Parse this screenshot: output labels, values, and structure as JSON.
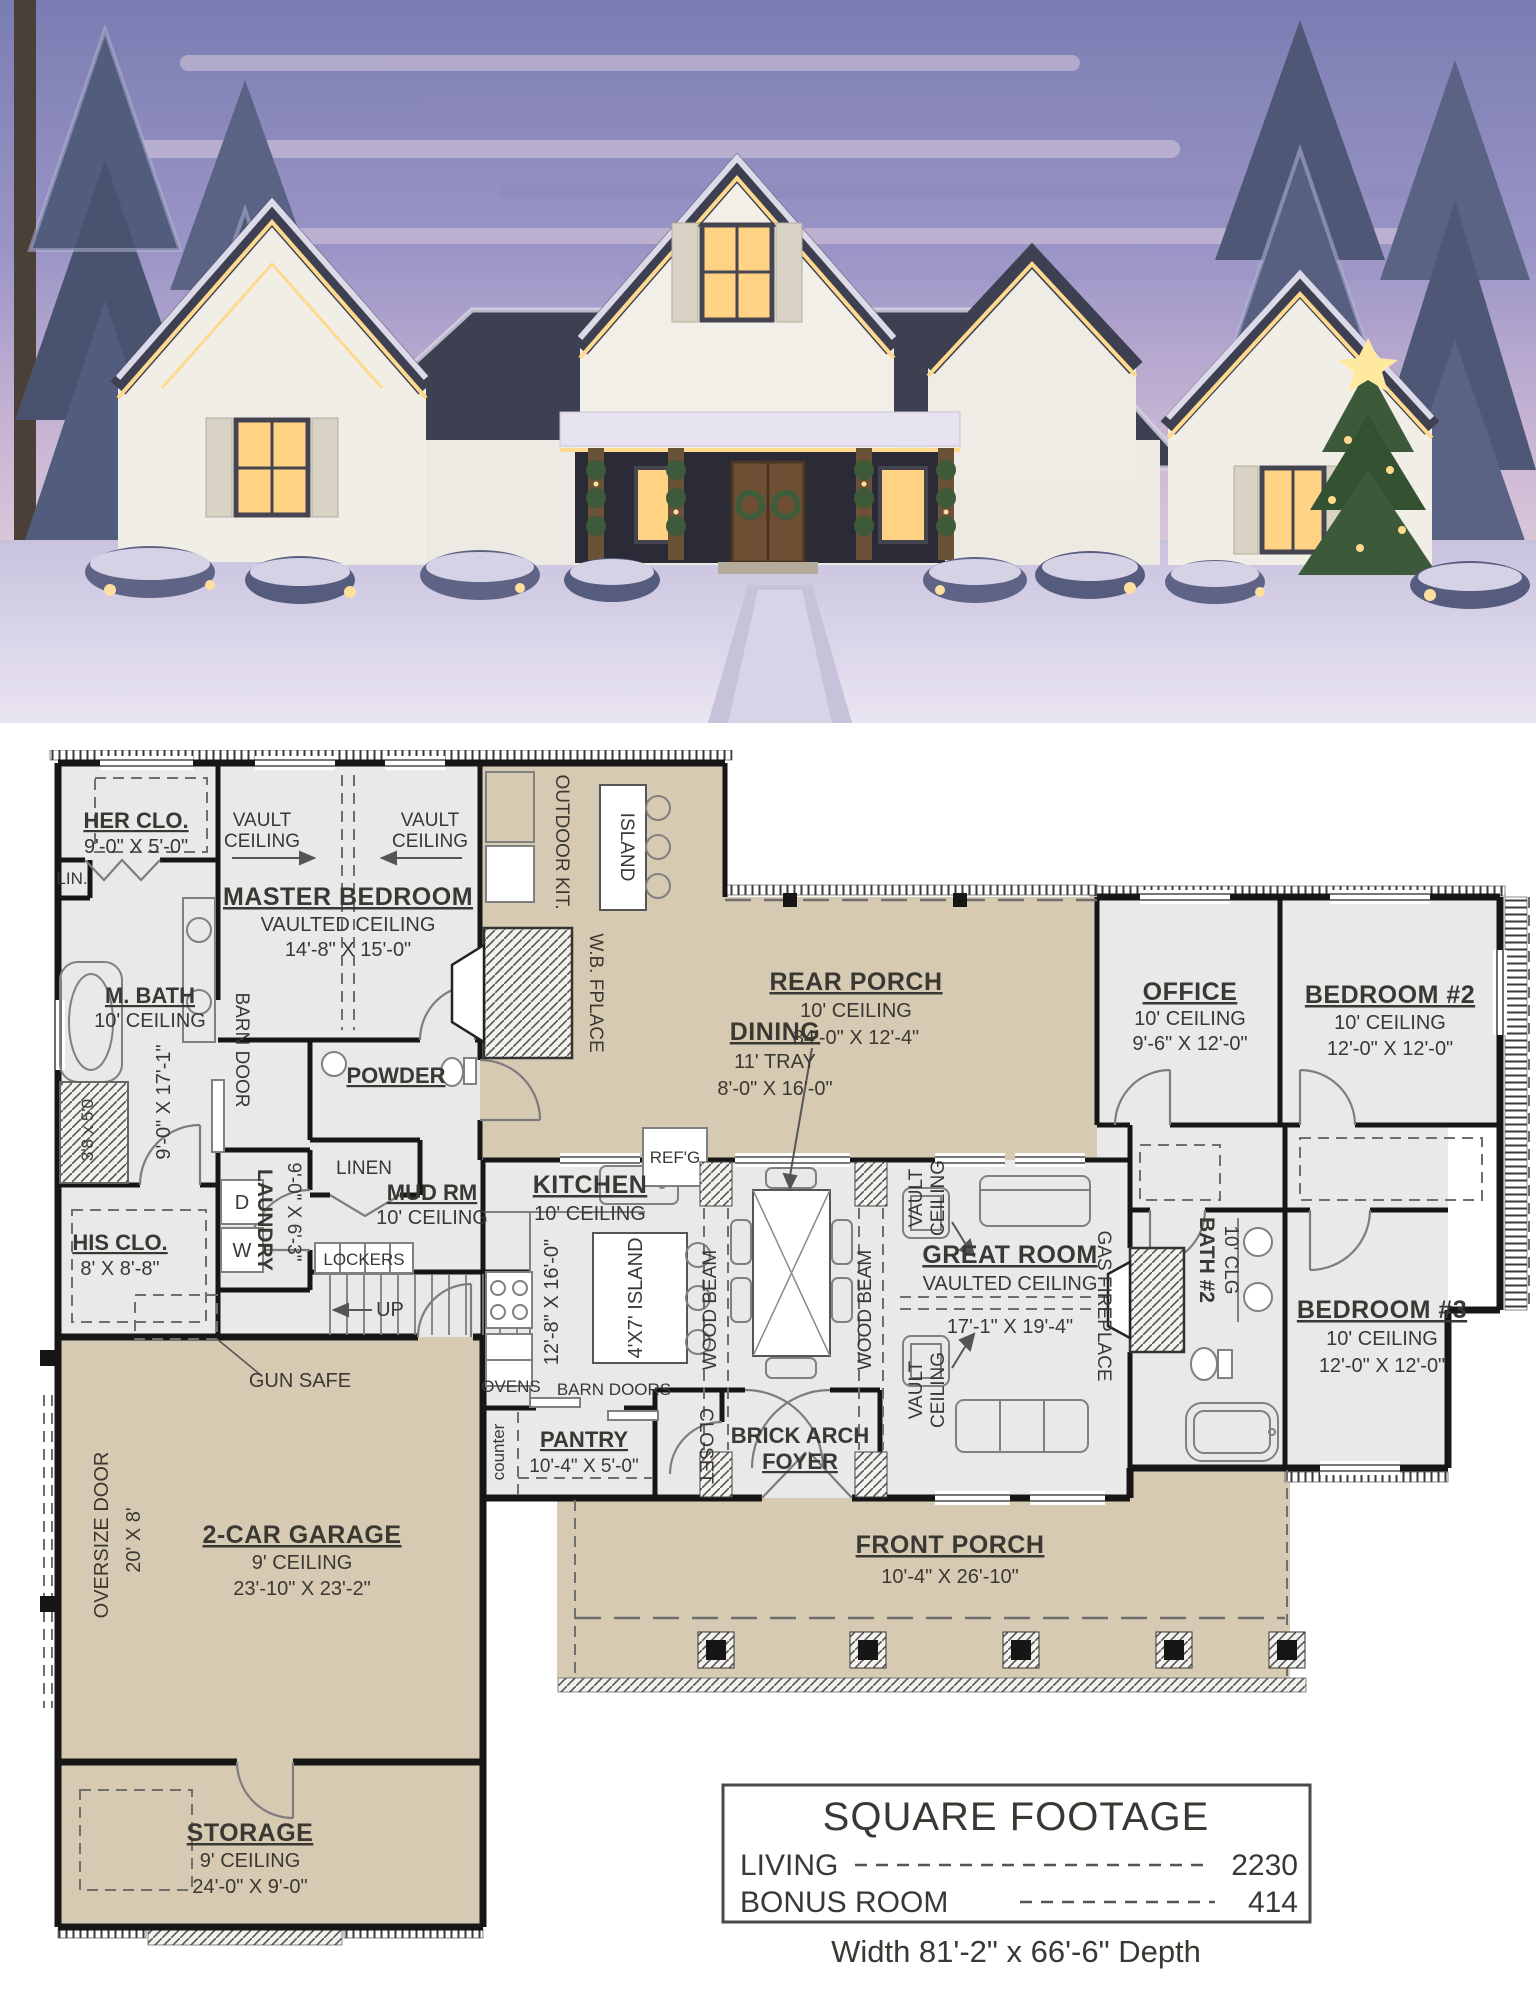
{
  "plan": {
    "her_clo": {
      "title": "HER CLO.",
      "dims": "9'-0\" X 5'-0\""
    },
    "lin": {
      "title": "LIN."
    },
    "m_bath": {
      "title": "M. BATH",
      "ceiling": "10' CEILING",
      "dims": "9'-0\" X 17'-1\""
    },
    "shower": {
      "dims": "3'8 x 5'0"
    },
    "his_clo": {
      "title": "HIS CLO.",
      "dims": "8' X 8'-8\""
    },
    "master": {
      "title": "MASTER BEDROOM",
      "ceiling": "VAULTED CEILING",
      "dims": "14'-8\" X 15'-0\"",
      "barn_door": "BARN DOOR"
    },
    "vault": {
      "l1": "VAULT",
      "l2": "CEILING"
    },
    "powder": {
      "title": "POWDER"
    },
    "linen": {
      "title": "LINEN"
    },
    "laundry": {
      "title": "LAUNDRY",
      "dims": "9'-0\" X 6'-3\"",
      "dryer": "D",
      "washer": "W"
    },
    "mud": {
      "title": "MUD RM",
      "ceiling": "10' CEILING"
    },
    "lockers": {
      "title": "LOCKERS"
    },
    "stairs": {
      "up": "UP"
    },
    "gun_safe": {
      "title": "GUN SAFE"
    },
    "outdoor": {
      "title": "OUTDOOR KIT.",
      "island": "ISLAND",
      "fireplace": "W.B. FPLACE"
    },
    "rear_porch": {
      "title": "REAR PORCH",
      "ceiling": "10' CEILING",
      "dims": "34'-0\" X 12'-4\""
    },
    "dining": {
      "title": "DINING",
      "tray": "11' TRAY",
      "dims": "8'-0\" X 16'-0\""
    },
    "kitchen": {
      "title": "KITCHEN",
      "ceiling": "10' CEILING",
      "dims": "12'-8\" X 16'-0\"",
      "island": "4'X7' ISLAND",
      "refg": "REF'G",
      "ovens": "OVENS",
      "barn_doors": "BARN DOORS"
    },
    "beams": {
      "label": "WOOD BEAM"
    },
    "great": {
      "title": "GREAT ROOM",
      "ceiling": "VAULTED CEILING",
      "dims": "17'-1\" X 19'-4\"",
      "fireplace": "GAS FIREPLACE"
    },
    "pantry": {
      "title": "PANTRY",
      "dims": "10'-4\" X 5'-0\"",
      "counter": "counter"
    },
    "closet": {
      "title": "CLOSET"
    },
    "foyer": {
      "line1": "BRICK ARCH",
      "line2": "FOYER"
    },
    "front_porch": {
      "title": "FRONT PORCH",
      "dims": "10'-4\" X 26'-10\""
    },
    "office": {
      "title": "OFFICE",
      "ceiling": "10' CEILING",
      "dims": "9'-6\" X 12'-0\""
    },
    "bedroom2": {
      "title": "BEDROOM #2",
      "ceiling": "10' CEILING",
      "dims": "12'-0\" X 12'-0\""
    },
    "bath2": {
      "title": "BATH #2",
      "ceiling": "10' CLG"
    },
    "bedroom3": {
      "title": "BEDROOM #3",
      "ceiling": "10' CEILING",
      "dims": "12'-0\" X 12'-0\""
    },
    "garage": {
      "title": "2-CAR GARAGE",
      "ceiling": "9' CEILING",
      "dims": "23'-10\" X 23'-2\"",
      "door_size": "20' X 8'",
      "door_label": "OVERSIZE DOOR"
    },
    "storage": {
      "title": "STORAGE",
      "ceiling": "9' CEILING",
      "dims": "24'-0\" X 9'-0\""
    }
  },
  "footage": {
    "title": "SQUARE FOOTAGE",
    "living_label": "LIVING",
    "living_value": "2230",
    "bonus_label": "BONUS ROOM",
    "bonus_value": "414",
    "overall": "Width 81'-2\" x 66'-6\" Depth"
  },
  "colors": {
    "porch_tan": "#d6cbb2",
    "room_gray": "#e9e9ea",
    "wall_black": "#161616",
    "plan_text": "#3b3833",
    "sky_dusk": "#8e8bc0",
    "roof_slate": "#3c4050",
    "warm_lights": "#ffd98e",
    "snow": "#e7e3f1"
  }
}
